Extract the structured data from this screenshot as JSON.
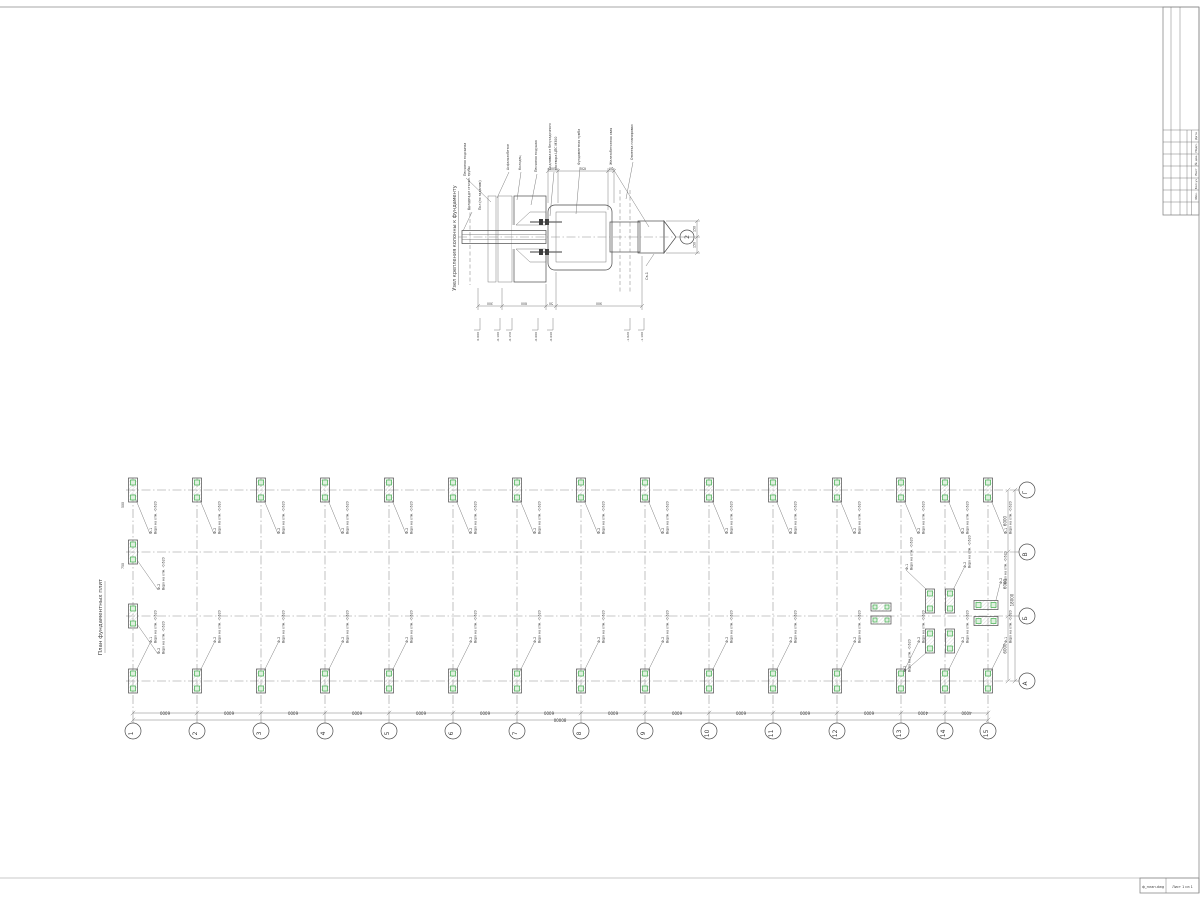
{
  "sheet": {
    "accent_green": "#3fae4c",
    "line_gray": "#4a4a4a"
  },
  "detail": {
    "title": "Узел крепления колонны к фундаменту",
    "labels": [
      "Песчаная подсыпка",
      "Асфальтобетон",
      "Колодец",
      "Песчаная подушка",
      "Подливка из безусадочного",
      "раствора ЦПС М300",
      "Фундаментная тумба",
      "Железобетонная свая",
      "Отметка планировки"
    ],
    "column_label1": "Колонна из стальн. трубы",
    "column_label2": "Пол (по заданию)",
    "pile_mark": "Св-1",
    "axis_bubble": "2",
    "top_dims": [
      "100",
      "650",
      "50"
    ],
    "bottom_dims": [
      "300",
      "600",
      "50",
      "900"
    ],
    "pile_dims": [
      "150",
      "150"
    ],
    "elevations": [
      "0.000",
      "-0.100",
      "-0.150",
      "-0.600",
      "-0.640",
      "-1.020",
      "-1.100"
    ]
  },
  "plan": {
    "title": "План фундаментных плит",
    "column_axis_labels": [
      "1",
      "2",
      "3",
      "4",
      "5",
      "6",
      "7",
      "8",
      "9",
      "10",
      "11",
      "12",
      "13",
      "14",
      "15"
    ],
    "row_axis_labels": [
      "Г",
      "В",
      "Б",
      "А"
    ],
    "bay_dims": [
      "6000",
      "6000",
      "6000",
      "6000",
      "6000",
      "6000",
      "6000",
      "6000",
      "6000",
      "6000",
      "6000",
      "6000",
      "4000",
      "4000"
    ],
    "total_dim": "80000",
    "row_dims": [
      "6000",
      "6000",
      "6000"
    ],
    "row_total_dim": "18000",
    "pad_mark_corner": "Ф-1",
    "pad_mark_typical": "Ф-2",
    "elev_note": "Верх на отм.",
    "elev_value": "-0.620",
    "pad_dims": [
      "500",
      "750"
    ]
  },
  "stamp": {
    "row_labels": [
      "Дата",
      "Подп.",
      "№ док.",
      "Лист",
      "Кол.уч",
      "Изм."
    ]
  },
  "footer": {
    "file_label": "ф_план.dwg",
    "sheet_label": "Лист 1 из 1"
  }
}
